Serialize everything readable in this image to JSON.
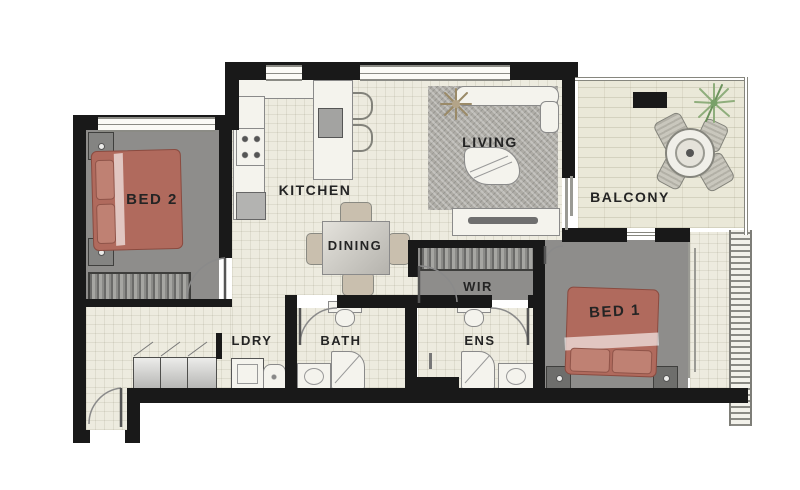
{
  "title": "Apartment floor plan",
  "labels": {
    "bed2": "BED 2",
    "kitchen": "KITCHEN",
    "dining": "DINING",
    "living": "LIVING",
    "balcony": "BALCONY",
    "wir": "WIR",
    "bed1": "BED 1",
    "ldry": "LDRY",
    "bath": "BATH",
    "ens": "ENS"
  },
  "colors": {
    "wall": "#191919",
    "floor": "#edebdf",
    "balconyFloor": "#eae8d8",
    "carpet": "#8e8d8b",
    "rug": "#aeaca6",
    "bed": "#b06a5d",
    "pillow": "#bf8173",
    "furnitureFill": "#f4f3ed",
    "furnitureLine": "#8a8a8a",
    "labelColor": "#242424",
    "plantGreen": "#86a873",
    "plantTan": "#9a8a68"
  }
}
